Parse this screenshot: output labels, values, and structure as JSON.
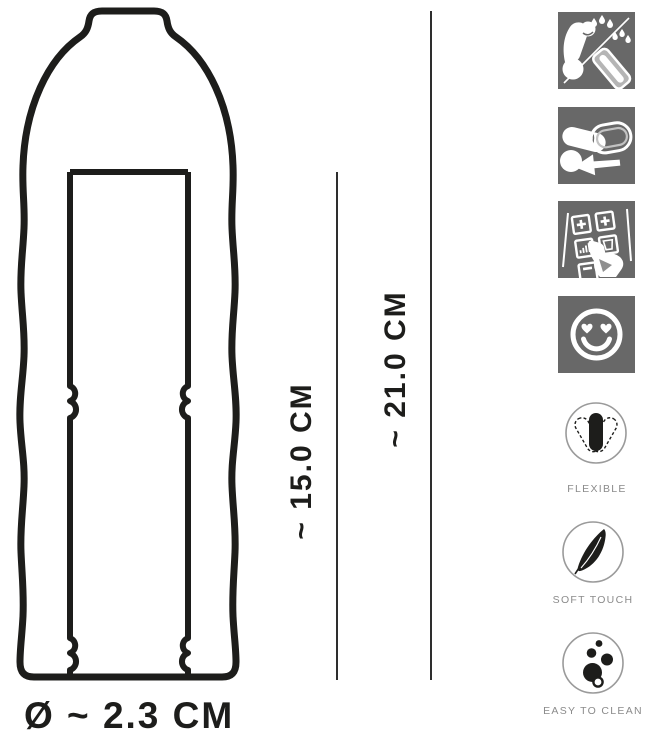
{
  "diagram": {
    "inner_length_label": "~ 15.0 CM",
    "total_length_label": "~ 21.0 CM",
    "diameter_label": "Ø ~ 2.3 CM"
  },
  "instruction_icons": [
    {
      "name": "apply-lubricant-icon"
    },
    {
      "name": "slide-on-sleeve-icon"
    },
    {
      "name": "select-options-icon"
    },
    {
      "name": "heart-eyes-smiley-icon"
    }
  ],
  "features": [
    {
      "icon": "flexible-sleeve-icon",
      "label": "FLEXIBLE"
    },
    {
      "icon": "feather-icon",
      "label": "SOFT TOUCH"
    },
    {
      "icon": "bubbles-icon",
      "label": "EASY TO CLEAN"
    }
  ],
  "colors": {
    "ink": "#1d1d1b",
    "icon_tile_gray": "#686868",
    "label_gray": "#8b8b8b",
    "background": "#ffffff"
  }
}
